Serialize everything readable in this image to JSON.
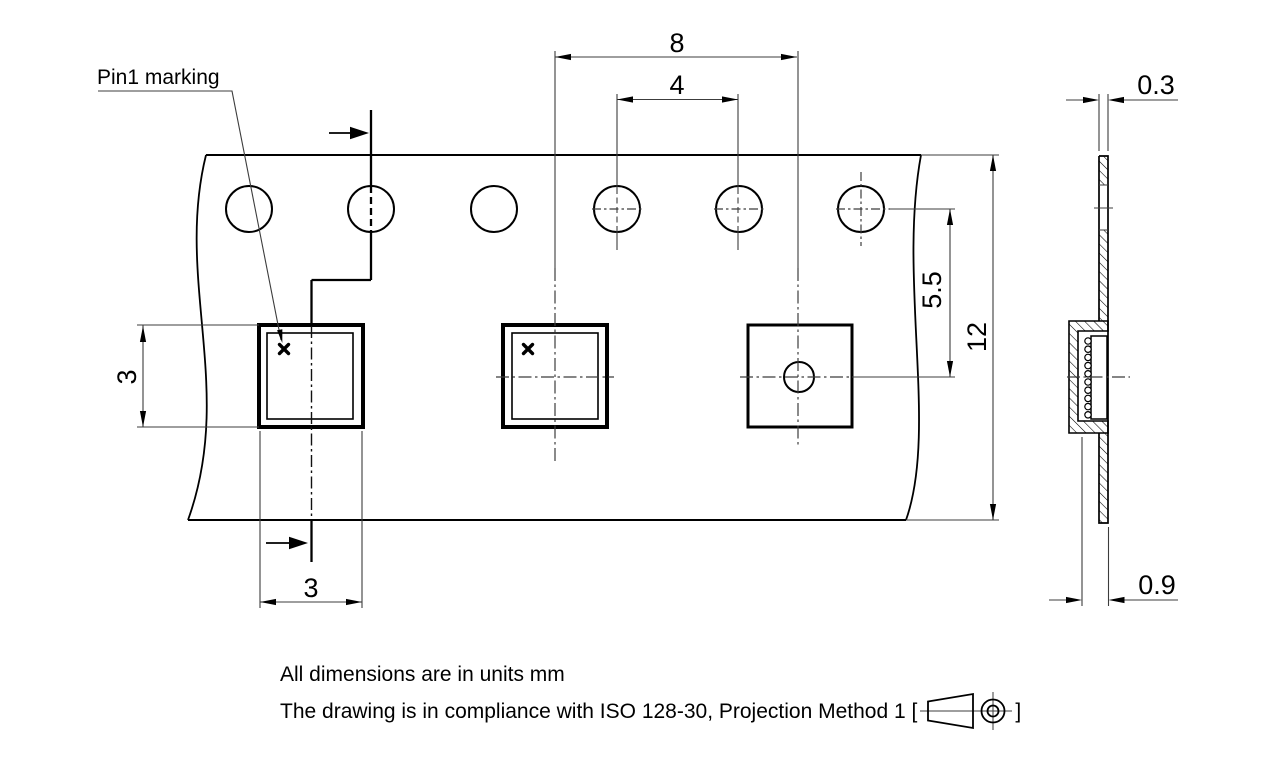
{
  "drawing": {
    "pin1_label": "Pin1 marking",
    "dimensions": {
      "pocket_pitch": "8",
      "sprocket_hole_pitch": "4",
      "hole_to_pocket_center": "5.5",
      "tape_width": "12",
      "pocket_size_vertical": "3",
      "pocket_size_horizontal": "3",
      "tape_thickness": "0.3",
      "pocket_depth": "0.9"
    },
    "notes": {
      "line1": "All dimensions are in units mm",
      "line2_prefix": "The drawing is in compliance with ISO 128-30, Projection Method 1 [",
      "line2_suffix": "]"
    },
    "colors": {
      "line": "#000000",
      "thin_line": "#3c3c3c",
      "background": "#ffffff"
    }
  }
}
